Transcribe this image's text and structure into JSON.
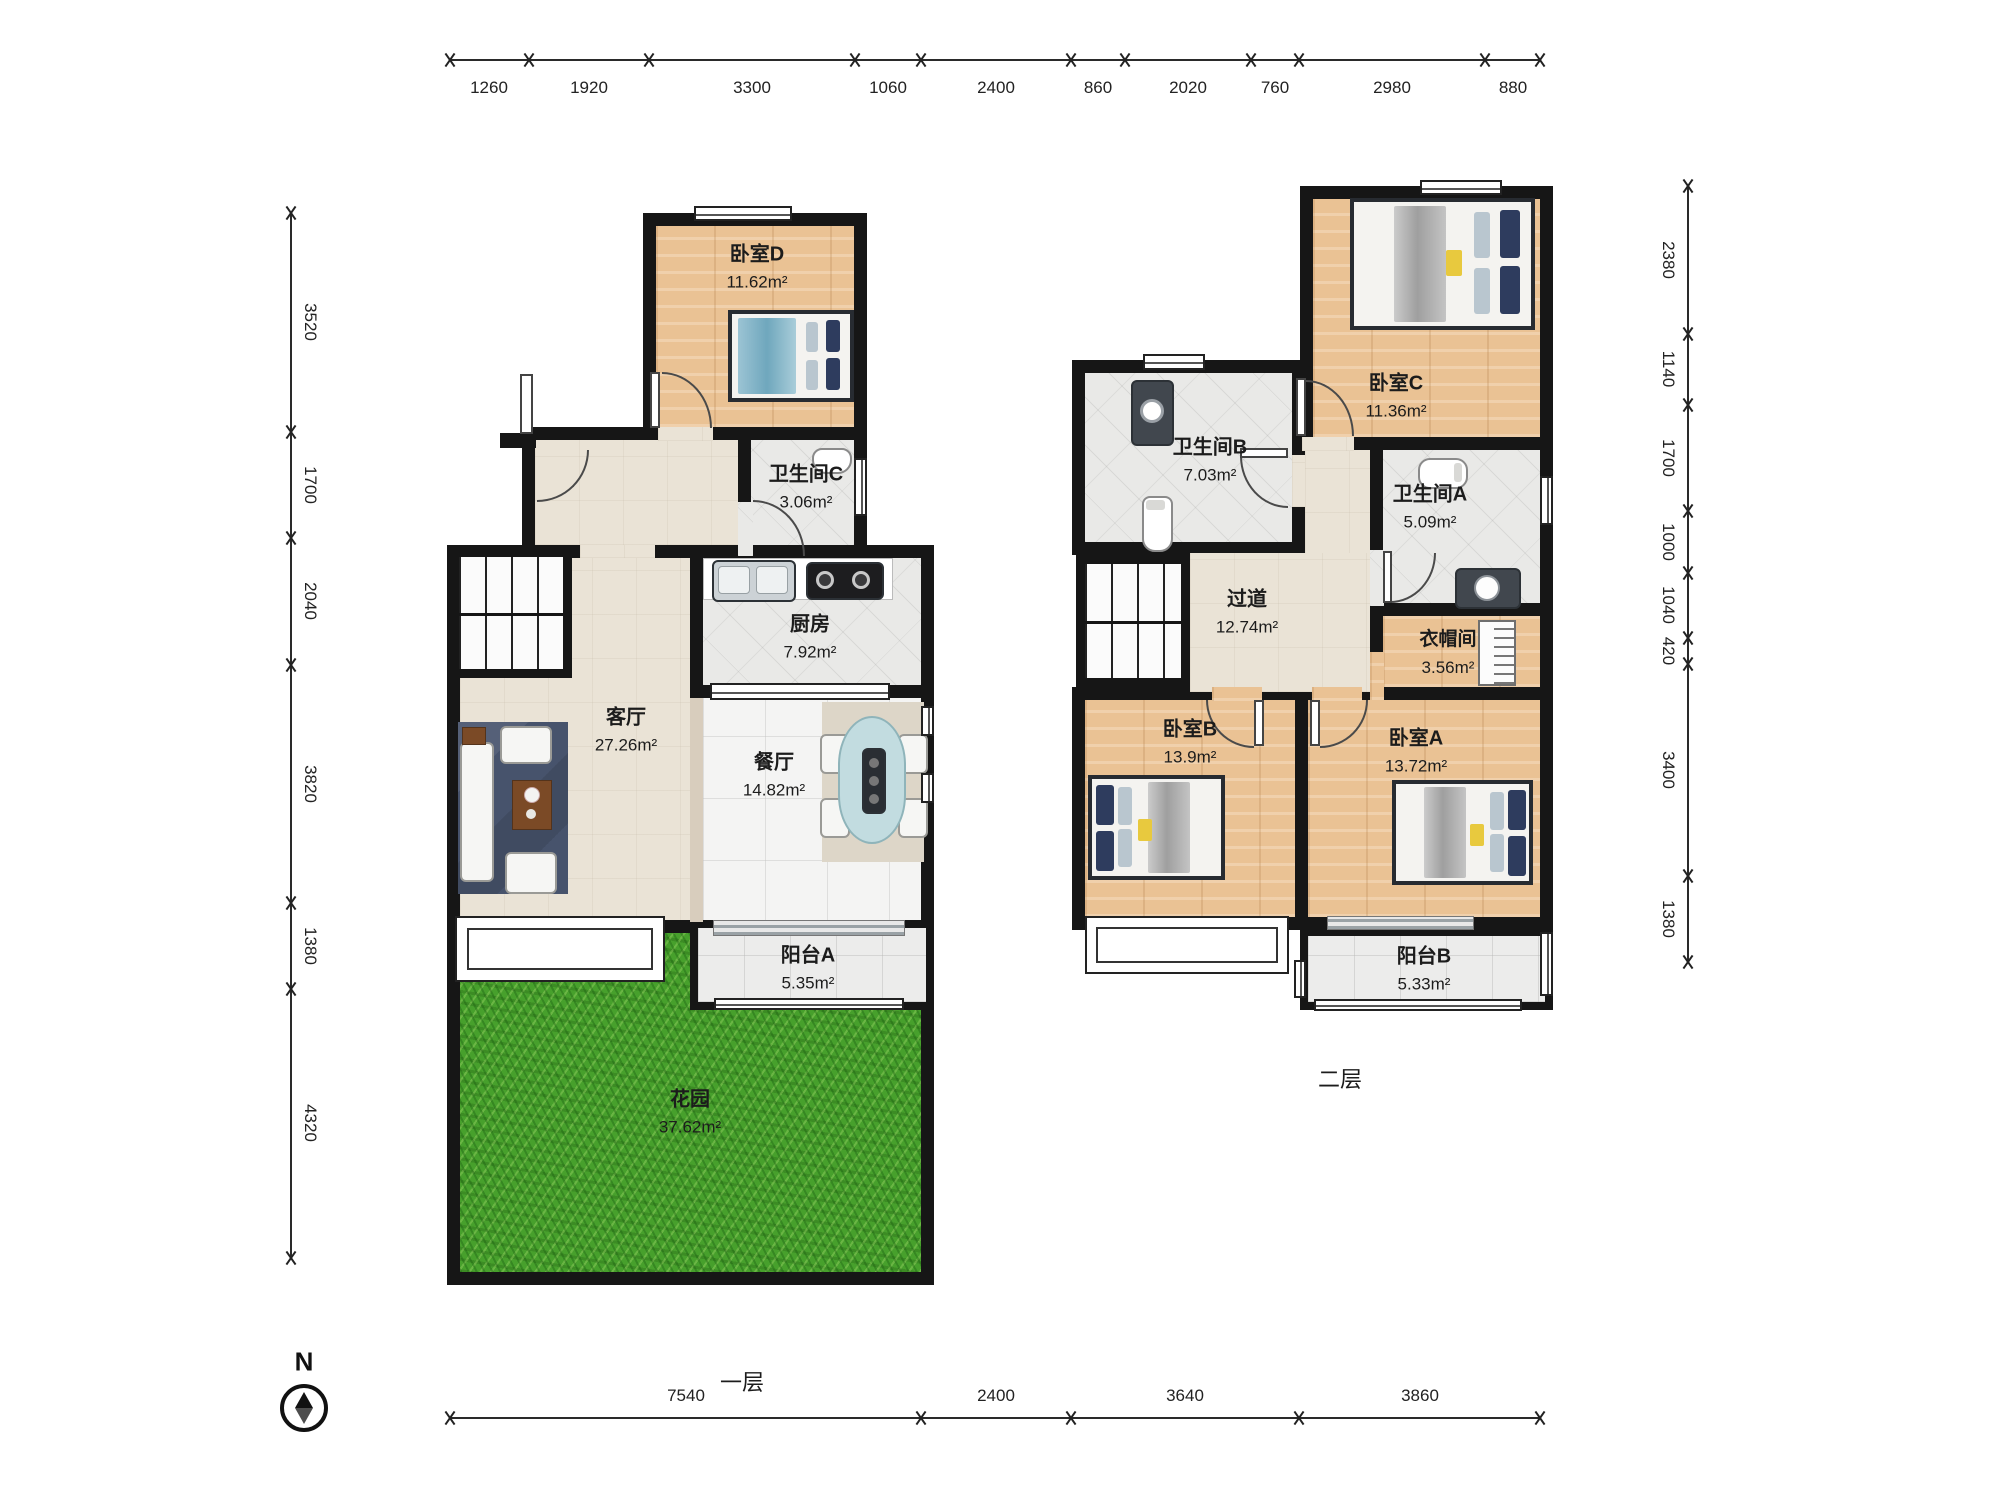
{
  "dims": {
    "top": [
      "1260",
      "1920",
      "3300",
      "1060",
      "2400",
      "860",
      "2020",
      "760",
      "2980",
      "880"
    ],
    "left": [
      "3520",
      "1700",
      "2040",
      "3820",
      "1380",
      "4320"
    ],
    "right": [
      "2380",
      "1140",
      "1700",
      "1000",
      "1040",
      "420",
      "3400",
      "1380"
    ],
    "bottom": [
      "7540",
      "2400",
      "3640",
      "3860"
    ]
  },
  "rooms": {
    "f1": [
      {
        "name": "卧室D",
        "area": "11.62m²"
      },
      {
        "name": "卫生间C",
        "area": "3.06m²"
      },
      {
        "name": "厨房",
        "area": "7.92m²"
      },
      {
        "name": "客厅",
        "area": "27.26m²"
      },
      {
        "name": "餐厅",
        "area": "14.82m²"
      },
      {
        "name": "阳台A",
        "area": "5.35m²"
      },
      {
        "name": "花园",
        "area": "37.62m²"
      }
    ],
    "f2": [
      {
        "name": "卧室C",
        "area": "11.36m²"
      },
      {
        "name": "卫生间B",
        "area": "7.03m²"
      },
      {
        "name": "卫生间A",
        "area": "5.09m²"
      },
      {
        "name": "过道",
        "area": "12.74m²"
      },
      {
        "name": "衣帽间",
        "area": "3.56m²"
      },
      {
        "name": "卧室B",
        "area": "13.9m²"
      },
      {
        "name": "卧室A",
        "area": "13.72m²"
      },
      {
        "name": "阳台B",
        "area": "5.33m²"
      }
    ]
  },
  "floor_labels": {
    "f1": "一层",
    "f2": "二层"
  },
  "compass": {
    "label": "N"
  },
  "colors": {
    "wall": "#161616",
    "wood": "#eac294",
    "tile": "#e9e9e7",
    "grass": "#47a02c",
    "beige": "#eae3d6"
  }
}
